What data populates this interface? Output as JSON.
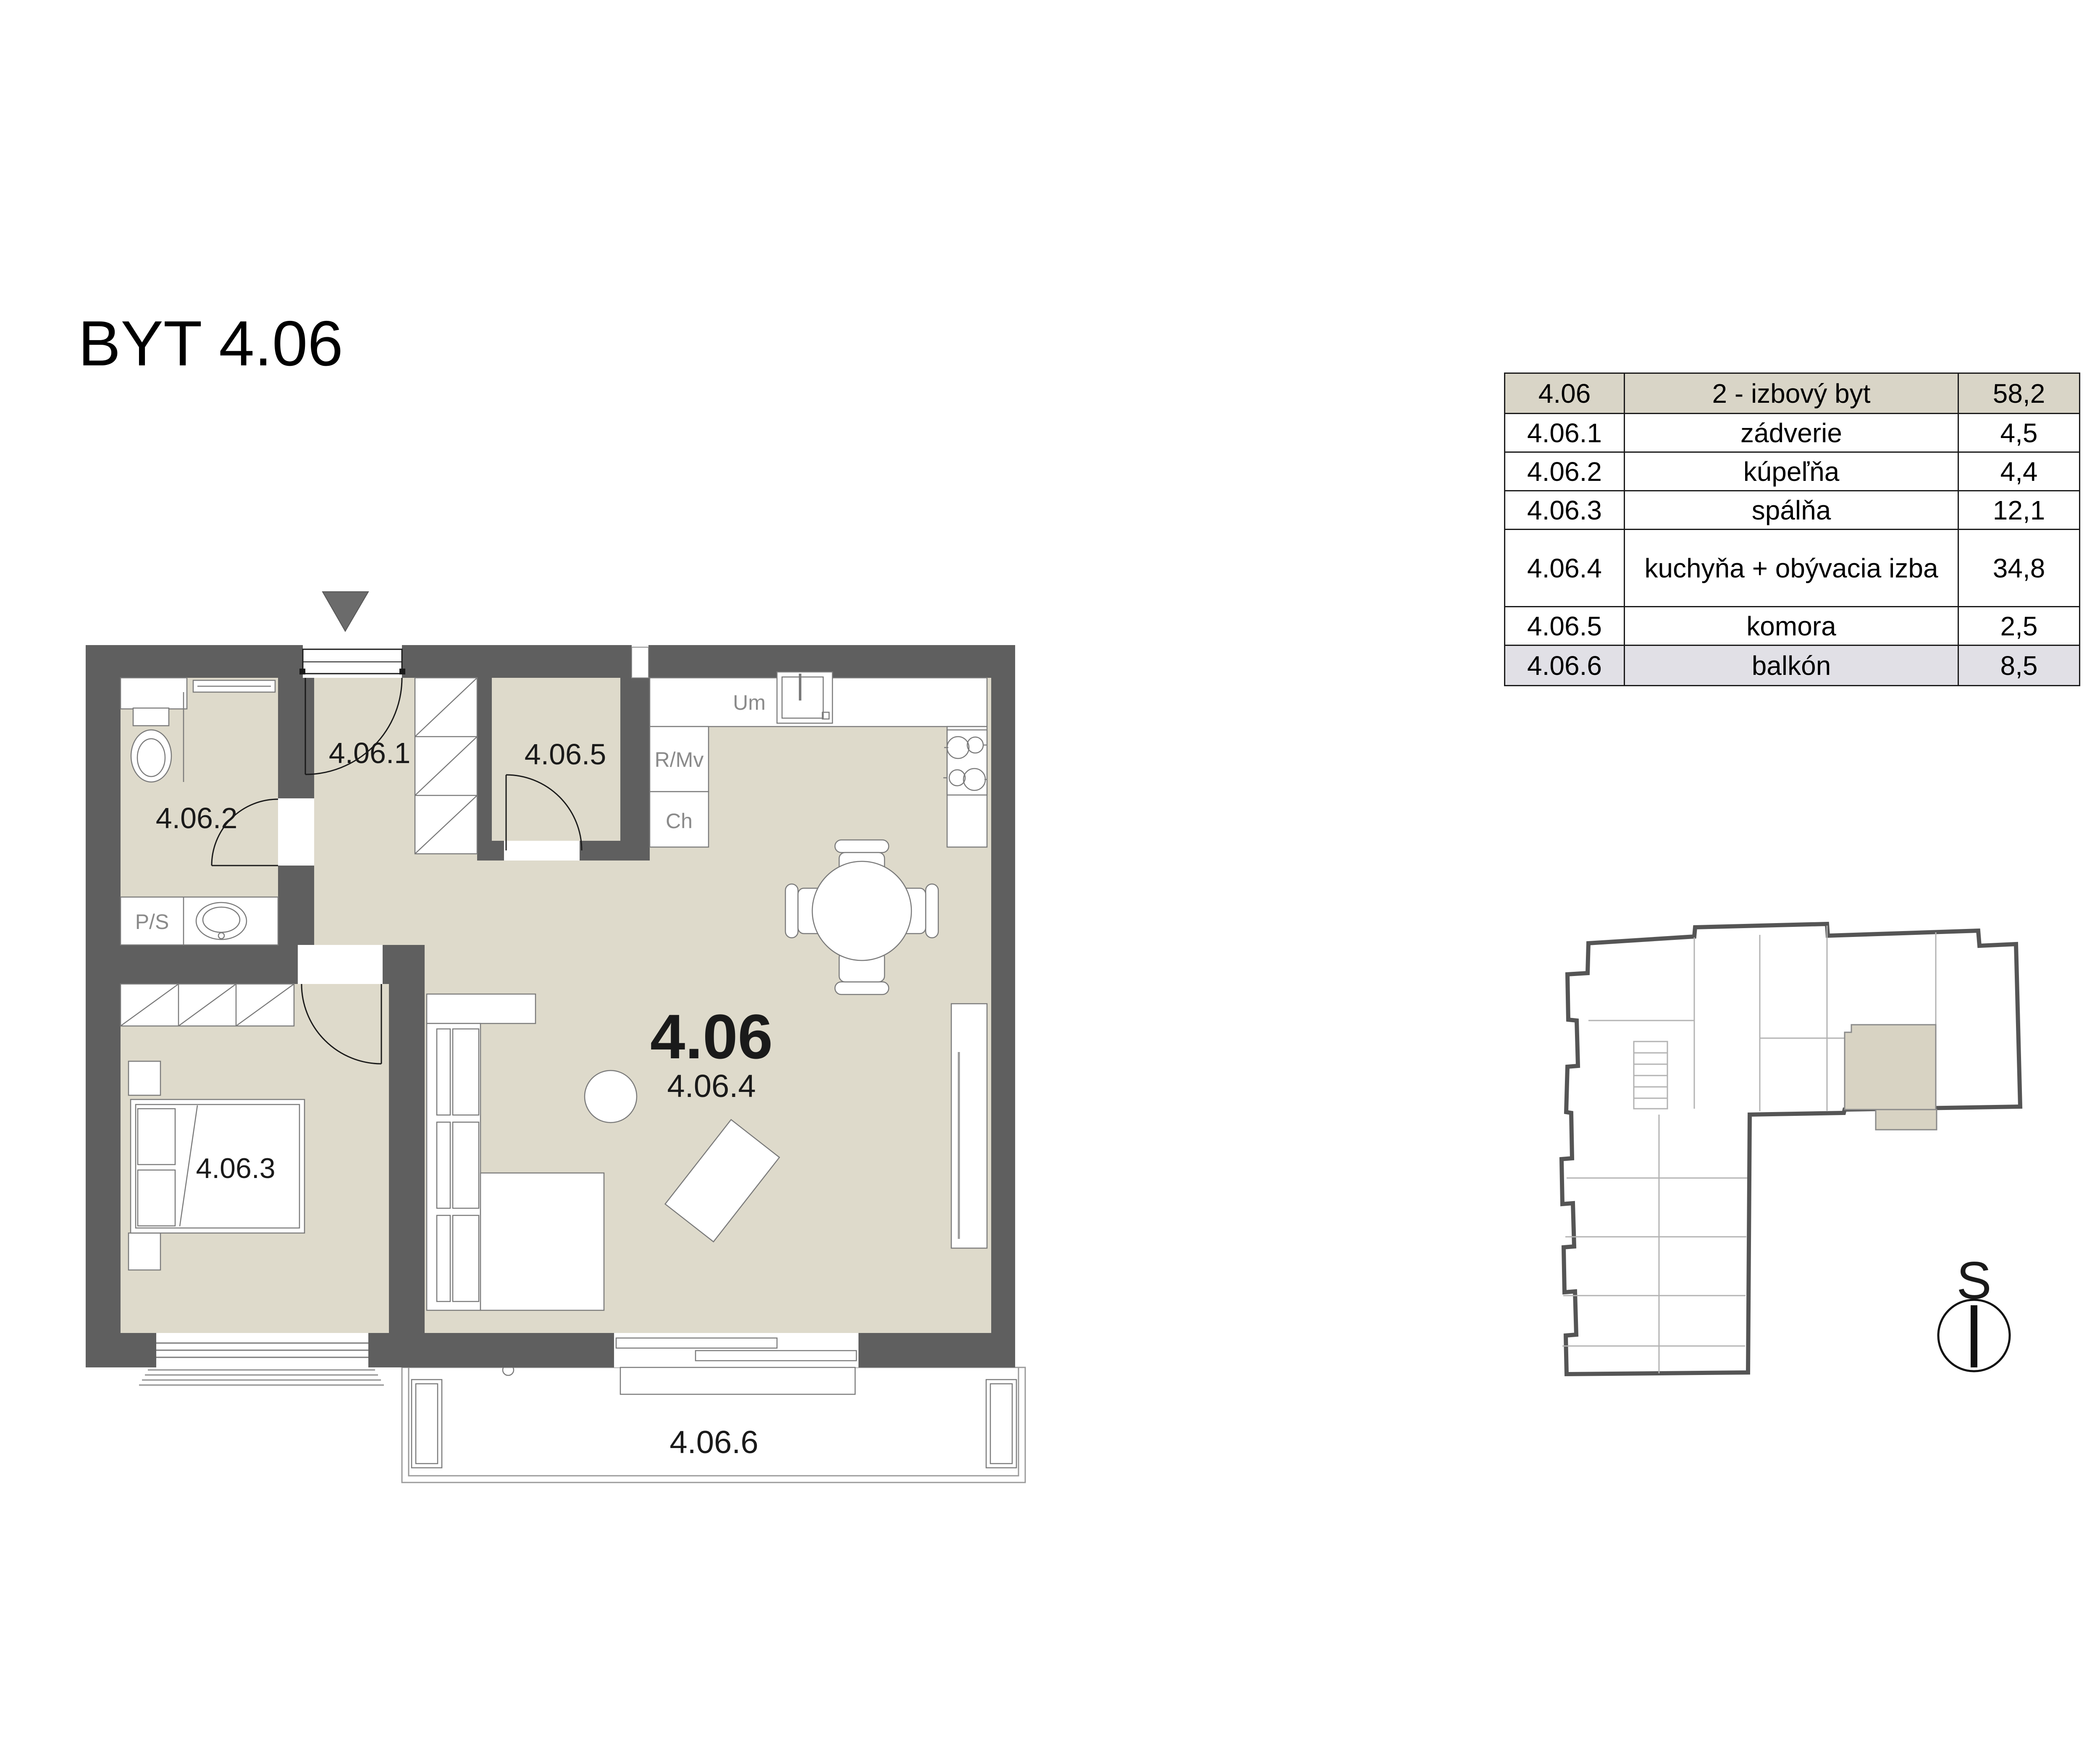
{
  "title": "BYT 4.06",
  "legend_table": {
    "rows": [
      {
        "id": "4.06",
        "name": "2 - izbový byt",
        "area": "58,2"
      },
      {
        "id": "4.06.1",
        "name": "zádverie",
        "area": "4,5"
      },
      {
        "id": "4.06.2",
        "name": "kúpeľňa",
        "area": "4,4"
      },
      {
        "id": "4.06.3",
        "name": "spálňa",
        "area": "12,1"
      },
      {
        "id": "4.06.4",
        "name": "kuchyňa + obývacia izba",
        "area": "34,8"
      },
      {
        "id": "4.06.5",
        "name": "komora",
        "area": "2,5"
      },
      {
        "id": "4.06.6",
        "name": "balkón",
        "area": "8,5"
      }
    ]
  },
  "floor_plan": {
    "unit_label": "4.06",
    "room_labels": {
      "entry": "4.06.1",
      "bathroom": "4.06.2",
      "bedroom": "4.06.3",
      "kitchen_living": "4.06.4",
      "pantry": "4.06.5",
      "balcony": "4.06.6"
    },
    "fixture_labels": {
      "washer_dryer": "P/S",
      "kitchen_sink": "Um",
      "oven_microwave": "R/Mv",
      "fridge": "Ch"
    }
  },
  "overview_map": {
    "north_label": "S"
  },
  "colors": {
    "wall": "#5f5f5f",
    "floor": "#dedacb",
    "table_header_bg": "#d9d5c7",
    "table_footer_bg": "#e1e0e6",
    "unit_highlight": "#d8d3c3",
    "entrance_arrow": "#6b6b6b"
  }
}
